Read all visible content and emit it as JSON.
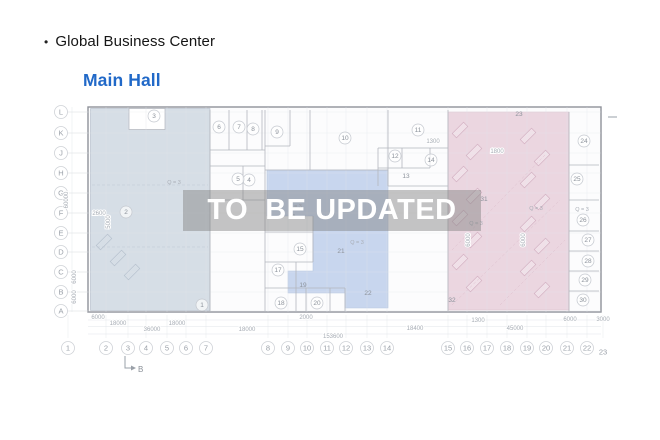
{
  "header": {
    "bullet": "•",
    "title": "Global Business Center",
    "subtitle": "Main Hall"
  },
  "watermark": {
    "text": "TO  BE UPDATED"
  },
  "colors": {
    "subtitle_blue": "#2169c8",
    "left_zone": "#d0d9e2",
    "middle_zone": "#bccdeb",
    "right_zone": "#e8cdd9",
    "watermark_band": "rgba(128,128,128,0.46)"
  },
  "plan": {
    "grid_rows": [
      {
        "label": "L",
        "y": 112
      },
      {
        "label": "K",
        "y": 133
      },
      {
        "label": "J",
        "y": 153
      },
      {
        "label": "H",
        "y": 173
      },
      {
        "label": "G",
        "y": 193
      },
      {
        "label": "F",
        "y": 213
      },
      {
        "label": "E",
        "y": 233
      },
      {
        "label": "D",
        "y": 252
      },
      {
        "label": "C",
        "y": 272
      },
      {
        "label": "B",
        "y": 292
      },
      {
        "label": "A",
        "y": 311
      }
    ],
    "grid_cols": [
      {
        "label": "1",
        "x": 68
      },
      {
        "label": "2",
        "x": 106
      },
      {
        "label": "3",
        "x": 128
      },
      {
        "label": "4",
        "x": 146
      },
      {
        "label": "5",
        "x": 167
      },
      {
        "label": "6",
        "x": 186
      },
      {
        "label": "7",
        "x": 206
      },
      {
        "label": "8",
        "x": 268
      },
      {
        "label": "9",
        "x": 288
      },
      {
        "label": "10",
        "x": 307
      },
      {
        "label": "11",
        "x": 327
      },
      {
        "label": "12",
        "x": 346
      },
      {
        "label": "13",
        "x": 367
      },
      {
        "label": "14",
        "x": 387
      },
      {
        "label": "15",
        "x": 448
      },
      {
        "label": "16",
        "x": 467
      },
      {
        "label": "17",
        "x": 487
      },
      {
        "label": "18",
        "x": 507
      },
      {
        "label": "19",
        "x": 527
      },
      {
        "label": "20",
        "x": 546
      },
      {
        "label": "21",
        "x": 567
      },
      {
        "label": "22",
        "x": 587
      },
      {
        "label": "23",
        "x": 603,
        "dy": 4,
        "plain": true
      }
    ],
    "rooms_circled": [
      {
        "n": "1",
        "x": 202,
        "y": 305
      },
      {
        "n": "2",
        "x": 126,
        "y": 212
      },
      {
        "n": "3",
        "x": 154,
        "y": 116
      },
      {
        "n": "4",
        "x": 249,
        "y": 180
      },
      {
        "n": "5",
        "x": 238,
        "y": 179
      },
      {
        "n": "6",
        "x": 219,
        "y": 127
      },
      {
        "n": "7",
        "x": 239,
        "y": 127
      },
      {
        "n": "8",
        "x": 253,
        "y": 129
      },
      {
        "n": "9",
        "x": 277,
        "y": 132
      },
      {
        "n": "10",
        "x": 345,
        "y": 138
      },
      {
        "n": "11",
        "x": 418,
        "y": 130
      },
      {
        "n": "12",
        "x": 395,
        "y": 156
      },
      {
        "n": "14",
        "x": 431,
        "y": 160
      },
      {
        "n": "15",
        "x": 300,
        "y": 249
      },
      {
        "n": "17",
        "x": 278,
        "y": 270
      },
      {
        "n": "18",
        "x": 281,
        "y": 303
      },
      {
        "n": "20",
        "x": 317,
        "y": 303
      },
      {
        "n": "24",
        "x": 584,
        "y": 141
      },
      {
        "n": "25",
        "x": 577,
        "y": 179
      },
      {
        "n": "26",
        "x": 583,
        "y": 220
      },
      {
        "n": "27",
        "x": 588,
        "y": 240
      },
      {
        "n": "28",
        "x": 588,
        "y": 261
      },
      {
        "n": "29",
        "x": 585,
        "y": 280
      },
      {
        "n": "30",
        "x": 583,
        "y": 300
      }
    ],
    "rooms_plain": [
      {
        "n": "13",
        "x": 406,
        "y": 176
      },
      {
        "n": "16",
        "x": 292,
        "y": 217
      },
      {
        "n": "19",
        "x": 303,
        "y": 285
      },
      {
        "n": "21",
        "x": 341,
        "y": 251
      },
      {
        "n": "22",
        "x": 368,
        "y": 293
      },
      {
        "n": "23",
        "x": 519,
        "y": 114
      },
      {
        "n": "31",
        "x": 484,
        "y": 199
      },
      {
        "n": "32",
        "x": 452,
        "y": 300
      }
    ],
    "q_labels": [
      {
        "text": "Q = 3",
        "x": 174,
        "y": 184
      },
      {
        "text": "Q = 3",
        "x": 295,
        "y": 208
      },
      {
        "text": "Q = 3",
        "x": 357,
        "y": 244
      },
      {
        "text": "Q = 3",
        "x": 476,
        "y": 225
      },
      {
        "text": "Q = 3",
        "x": 536,
        "y": 210
      },
      {
        "text": "Q = 3",
        "x": 582,
        "y": 211
      }
    ],
    "dims_h": [
      {
        "text": "6000",
        "x": 98,
        "y": 319
      },
      {
        "text": "18000",
        "x": 118,
        "y": 325
      },
      {
        "text": "18000",
        "x": 177,
        "y": 325
      },
      {
        "text": "36000",
        "x": 152,
        "y": 331
      },
      {
        "text": "18000",
        "x": 247,
        "y": 331
      },
      {
        "text": "153600",
        "x": 333,
        "y": 338
      },
      {
        "text": "2000",
        "x": 306,
        "y": 319
      },
      {
        "text": "18400",
        "x": 415,
        "y": 330
      },
      {
        "text": "1300",
        "x": 478,
        "y": 322
      },
      {
        "text": "45000",
        "x": 515,
        "y": 330
      },
      {
        "text": "6000",
        "x": 570,
        "y": 321
      },
      {
        "text": "3000",
        "x": 603,
        "y": 321
      },
      {
        "text": "1300",
        "x": 433,
        "y": 143
      },
      {
        "text": "1800",
        "x": 497,
        "y": 153
      },
      {
        "text": "2600",
        "x": 99,
        "y": 215
      }
    ],
    "dims_v": [
      {
        "text": "60000",
        "x": 68,
        "y": 200
      },
      {
        "text": "6000",
        "x": 76,
        "y": 277
      },
      {
        "text": "6000",
        "x": 76,
        "y": 297
      },
      {
        "text": "5000",
        "x": 110,
        "y": 222
      },
      {
        "text": "6000",
        "x": 470,
        "y": 240
      },
      {
        "text": "6000",
        "x": 525,
        "y": 240
      }
    ],
    "section_marker": {
      "label": "B"
    }
  }
}
